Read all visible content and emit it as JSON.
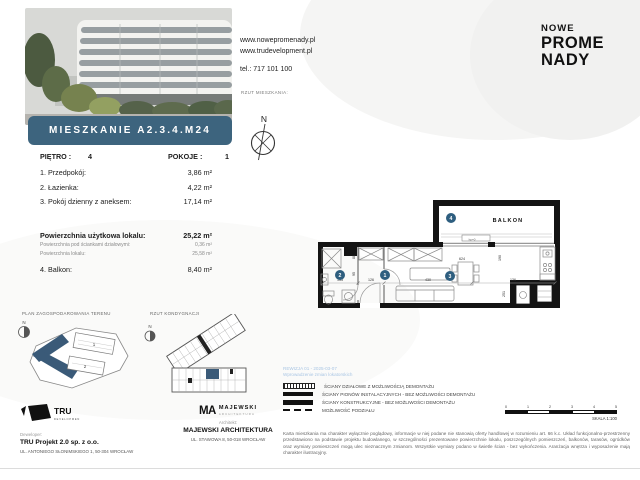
{
  "colors": {
    "accent": "#3d647e",
    "marker": "#2e5e7f",
    "site_highlight": "#3a5a78",
    "revision_blue": "#aac6e4"
  },
  "header": {
    "websites": [
      "www.nowepromenady.pl",
      "www.trudevelopment.pl"
    ],
    "phone": "tel.: 717 101 100",
    "plan_label": "RZUT MIESZKANIA:",
    "logo": {
      "line1": "NOWE",
      "line2": "PROME",
      "line3": "NADY"
    }
  },
  "apartment": {
    "title": "MIESZKANIE A2.3.4.M24",
    "floor_label": "PIĘTRO :",
    "floor_value": "4",
    "rooms_label": "POKOJE :",
    "rooms_value": "1",
    "rooms": [
      {
        "name": "1. Przedpokój:",
        "area": "3,86  m²"
      },
      {
        "name": "2. Łazienka:",
        "area": "4,22  m²"
      },
      {
        "name": "3. Pokój dzienny z aneksem:",
        "area": "17,14  m²"
      }
    ],
    "usable_label": "Powierzchnia użytkowa lokalu:",
    "usable_area": "25,22  m²",
    "partition_label": "Powierzchnia pod ściankami działowymi:",
    "partition_area": "0,36  m²",
    "local_label": "Powierzchnia lokalu:",
    "local_area": "25,58  m²",
    "balcony_label": "4. Balkon:",
    "balcony_area": "8,40  m²"
  },
  "mini_plans": {
    "site_label": "PLAN ZAGOSPODAROWANIA TERENU",
    "storey_label": "RZUT KONDYGNACJI",
    "site_numbers": [
      "1",
      "2"
    ],
    "north": "N"
  },
  "floorplan": {
    "balcony": "BALKON",
    "north": "N",
    "markers": {
      "m1": "1",
      "m2": "2",
      "m3": "3",
      "m4": "4"
    },
    "dims": {
      "d153": "153",
      "d126": "126",
      "d430": "430",
      "d136": "136",
      "d624": "624",
      "d88": "88",
      "d95": "95",
      "d190": "190",
      "d251": "251",
      "hp": "hp=0"
    }
  },
  "revision": {
    "line1": "REWIZJA 01 - 2025-03-07",
    "line2": "Wprowadzenie zmian lokatorskich"
  },
  "legend": {
    "items": [
      {
        "label": "ŚCIANY DZIAŁOWE Z MOŻLIWOŚCIĄ DEMONTAŻU"
      },
      {
        "label": "ŚCIANY PIONÓW INSTALACYJNYCH - BEZ MOŻLIWOŚCI DEMONTAŻU"
      },
      {
        "label": "ŚCIANY KONSTRUKCYJNE - BEZ MOŻLIWOŚCI DEMONTAŻU"
      },
      {
        "label": "MOŻLIWOŚĆ PODZIAŁU"
      }
    ]
  },
  "footer": {
    "developer": {
      "role": "Deweloper:",
      "name": "TRU Projekt 2.0 sp. z o.o.",
      "address": "UL. ANTONIEGO SŁONIMSKIEGO 1, 50-304 WROCŁAW",
      "logo_text": "TRU",
      "logo_sub": "DEVELOPMENT"
    },
    "architect": {
      "role": "Architekt:",
      "name": "MAJEWSKI ARCHITEKTURA",
      "address": "UL. STAWOWA 8, 50-018 WROCŁAW",
      "logo_ma": "MA",
      "logo_name": "MAJEWSKI",
      "logo_sub": "ARCHITEKTURA"
    },
    "scale": {
      "ticks": [
        "0",
        "1",
        "2",
        "3",
        "4",
        "5"
      ],
      "label": "SKALA 1:100"
    },
    "disclaimer": "Karta mieszkania ma charakter wyłącznie poglądowy, informacje w niej podane nie stanowią oferty handlowej w rozumieniu art. 66 k.c. Układ funkcjonalno-przestrzenny przedstawiono na podstawie projektu budowlanego, w szczególności prezentowane powierzchnie lokalu, poszczególnych pomieszczeń, balkonów, tarasów, ogródków oraz wymiary pomieszczeń mogą ulec nieznacznym zmianom. Wszystkie wymiary podano w świetle ścian - bez wykończenia. Aranżacja wnętrza i wyposażenie mają charakter ilustracyjny."
  }
}
